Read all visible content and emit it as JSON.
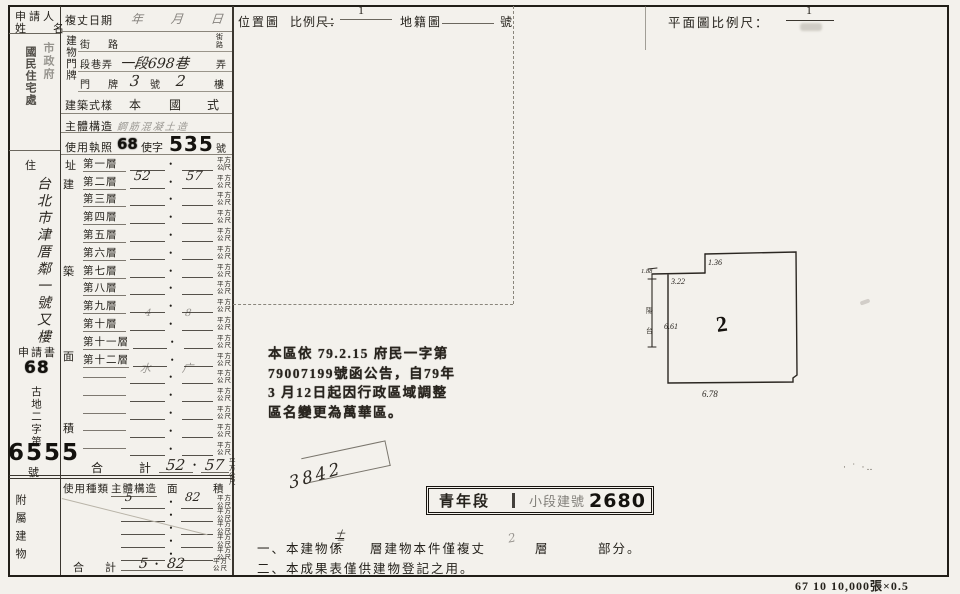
{
  "form": {
    "applicant": {
      "label_top": "申請人",
      "label_bottom": "姓　名",
      "stamp_right": "市政府",
      "stamp_left": "國民住宅處"
    },
    "survey": {
      "label": "複丈日期",
      "hw_value": "年　月　日"
    },
    "plate": {
      "vertical": "建物門牌",
      "street_label": "街　路",
      "street_suffix_top": "街",
      "street_suffix_bottom": "路",
      "section_label": "段巷弄",
      "section_hw": "一段698巷",
      "section_suffix": "弄",
      "door_label": "門　牌",
      "door_hw_no": "3",
      "door_no_label": "號",
      "door_hw_fl": "2",
      "door_fl_label": "樓"
    },
    "style": {
      "label": "建築式樣",
      "v1": "本",
      "v2": "國",
      "v3": "式"
    },
    "structure": {
      "label": "主體構造",
      "hw_value": "鋼筋混凝土造"
    },
    "license": {
      "label": "使用執照",
      "year": "68",
      "mid": "使字",
      "no": "535",
      "suffix": "號"
    },
    "address": {
      "label": "住　址",
      "hw_value": "台北市津厝鄰一號又樓"
    },
    "area_vertical": [
      "建",
      "築",
      "面",
      "積"
    ],
    "floors": {
      "dot": "•",
      "unit_top": "平方",
      "unit_bottom": "公尺",
      "rows": [
        {
          "label": "第一層",
          "l": "",
          "r": ""
        },
        {
          "label": "第二層",
          "l": "52",
          "r": "57"
        },
        {
          "label": "第三層",
          "l": "",
          "r": ""
        },
        {
          "label": "第四層",
          "l": "",
          "r": ""
        },
        {
          "label": "第五層",
          "l": "",
          "r": ""
        },
        {
          "label": "第六層",
          "l": "",
          "r": ""
        },
        {
          "label": "第七層",
          "l": "",
          "r": ""
        },
        {
          "label": "第八層",
          "l": "",
          "r": ""
        },
        {
          "label": "第九層",
          "l": "",
          "r": ""
        },
        {
          "label": "第十層",
          "l": "",
          "r": ""
        },
        {
          "label": "第十一層",
          "l": "",
          "r": ""
        },
        {
          "label": "第十二層",
          "l": "",
          "r": ""
        },
        {
          "label": "",
          "l": "",
          "r": ""
        },
        {
          "label": "",
          "l": "",
          "r": ""
        },
        {
          "label": "",
          "l": "",
          "r": ""
        },
        {
          "label": "",
          "l": "",
          "r": ""
        },
        {
          "label": "",
          "l": "",
          "r": ""
        }
      ],
      "total_no": "號",
      "total_l1": "合",
      "total_l2": "計",
      "total_left": "52",
      "total_right": "57"
    },
    "docno": {
      "label": "申請書",
      "year": "68",
      "vertical": "古地二字第",
      "number": "6555",
      "suffix": "號"
    },
    "annex": {
      "h1": "使用種類",
      "h2": "主體構造",
      "h3": "面",
      "h4": "積",
      "vertical": "附屬建物",
      "rows": [
        {
          "l": "5",
          "r": "82"
        },
        {
          "l": "",
          "r": ""
        },
        {
          "l": "",
          "r": ""
        },
        {
          "l": "",
          "r": ""
        },
        {
          "l": "",
          "r": ""
        }
      ],
      "total_l1": "合",
      "total_l2": "計",
      "total_left": "5",
      "total_right": "82"
    }
  },
  "position_map": {
    "title": "位置圖",
    "scale_label": "比例尺：",
    "scale_num": "1",
    "cadastral_label": "地籍圖",
    "no_label": "號"
  },
  "plan": {
    "title": "平面圖比例尺：",
    "scale_num": "1"
  },
  "drawing": {
    "dim_top_notch": "1.36",
    "dim_upper_left": "3.22",
    "dim_strip": "1.88",
    "dim_left": "6.61",
    "dim_bottom": "6.78",
    "floor_mark": "2",
    "strip_char_1": "陽",
    "strip_char_2": "台"
  },
  "notice": {
    "lines": [
      "本區依 79.2.15 府民一字第",
      "79007199號函公告，自79年",
      "3 月12日起因行政區域調整",
      "區名變更為萬華區。"
    ]
  },
  "hw_number": "3842",
  "section_stamp": {
    "left": "青年段",
    "mid": "｜",
    "small": "小段建號",
    "no": "2680"
  },
  "notes": {
    "n1_pre": "一、本建物係",
    "n1_hw_top": "十",
    "n1_hw_bottom": "二",
    "n1_mid": "層建物本件僅複丈",
    "n1_hw2": "2",
    "n1_fl": "層",
    "n1_end": "部分。",
    "n2": "二、本成果表僅供建物登記之用。"
  },
  "faint": {
    "f9l": "4",
    "f9r": "8",
    "f12l": "水",
    "f12r": "广",
    "ink_dots": "· ˙ ·‥"
  },
  "footer": "67 10 10,000張×0.5"
}
